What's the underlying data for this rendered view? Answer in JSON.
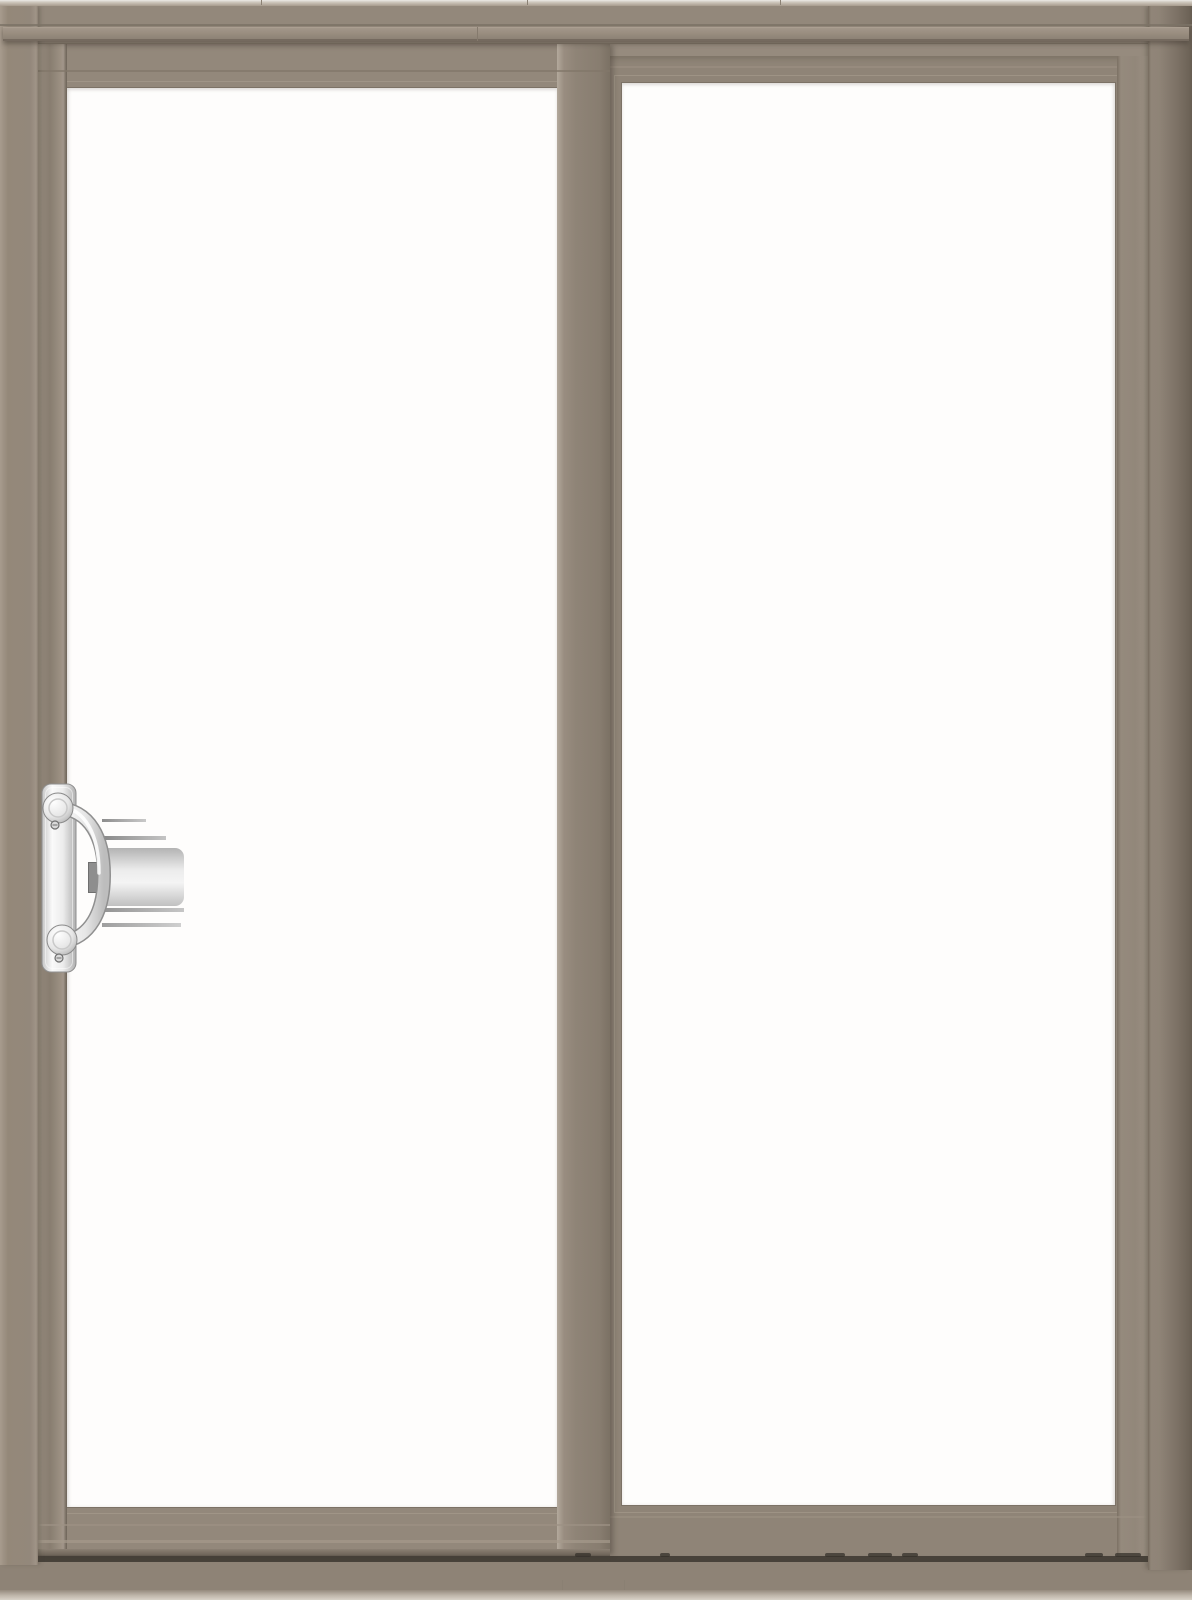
{
  "scene": {
    "title": "Two-panel sliding patio door",
    "description": "Product rendering of a gliding patio door with a taupe frame; left operating panel with chrome handle, right fixed panel, clear glass",
    "panel_count": 2,
    "handle_position": "left panel, left stile"
  },
  "colors": {
    "frame_main": "#968b7e",
    "frame_face": "#93887b",
    "frame_highlight": "#a89c8e",
    "frame_dark": "#7b7164",
    "frame_edge_dark": "#665c51",
    "top_edge_light": "#eceae6",
    "glass": "#fefdfc",
    "track_dark": "#48423a",
    "sill_bottom_light": "#d8d2c8",
    "handle_chrome_light": "#fafafa",
    "handle_chrome_mid": "#d9d9d9",
    "handle_chrome_dark": "#a8a8a8",
    "reflection_gray": "#c9c9c9"
  },
  "parts": {
    "door": {
      "label": "Sliding patio door"
    },
    "frame": {
      "label": "Outer door frame"
    },
    "head": {
      "label": "Head frame"
    },
    "head_trim": {
      "label": "Head trim band"
    },
    "left_jamb": {
      "label": "Left jamb"
    },
    "right_jamb": {
      "label": "Right jamb"
    },
    "sill": {
      "label": "Sill"
    },
    "track": {
      "label": "Sill track"
    },
    "sliding_panel": {
      "label": "Sliding panel (left, operable)"
    },
    "sliding_glass": {
      "label": "Sliding panel glass"
    },
    "fixed_panel": {
      "label": "Fixed panel (right)"
    },
    "fixed_glass": {
      "label": "Fixed panel glass"
    },
    "handle": {
      "label": "Chrome door handle"
    },
    "handle_plate": {
      "label": "Handle backplate"
    },
    "handle_grip": {
      "label": "Handle pull grip"
    },
    "keeper": {
      "label": "Latch keeper"
    },
    "reflection": {
      "label": "Handle reflection in glass"
    },
    "weep": {
      "label": "Track weep slot"
    }
  }
}
